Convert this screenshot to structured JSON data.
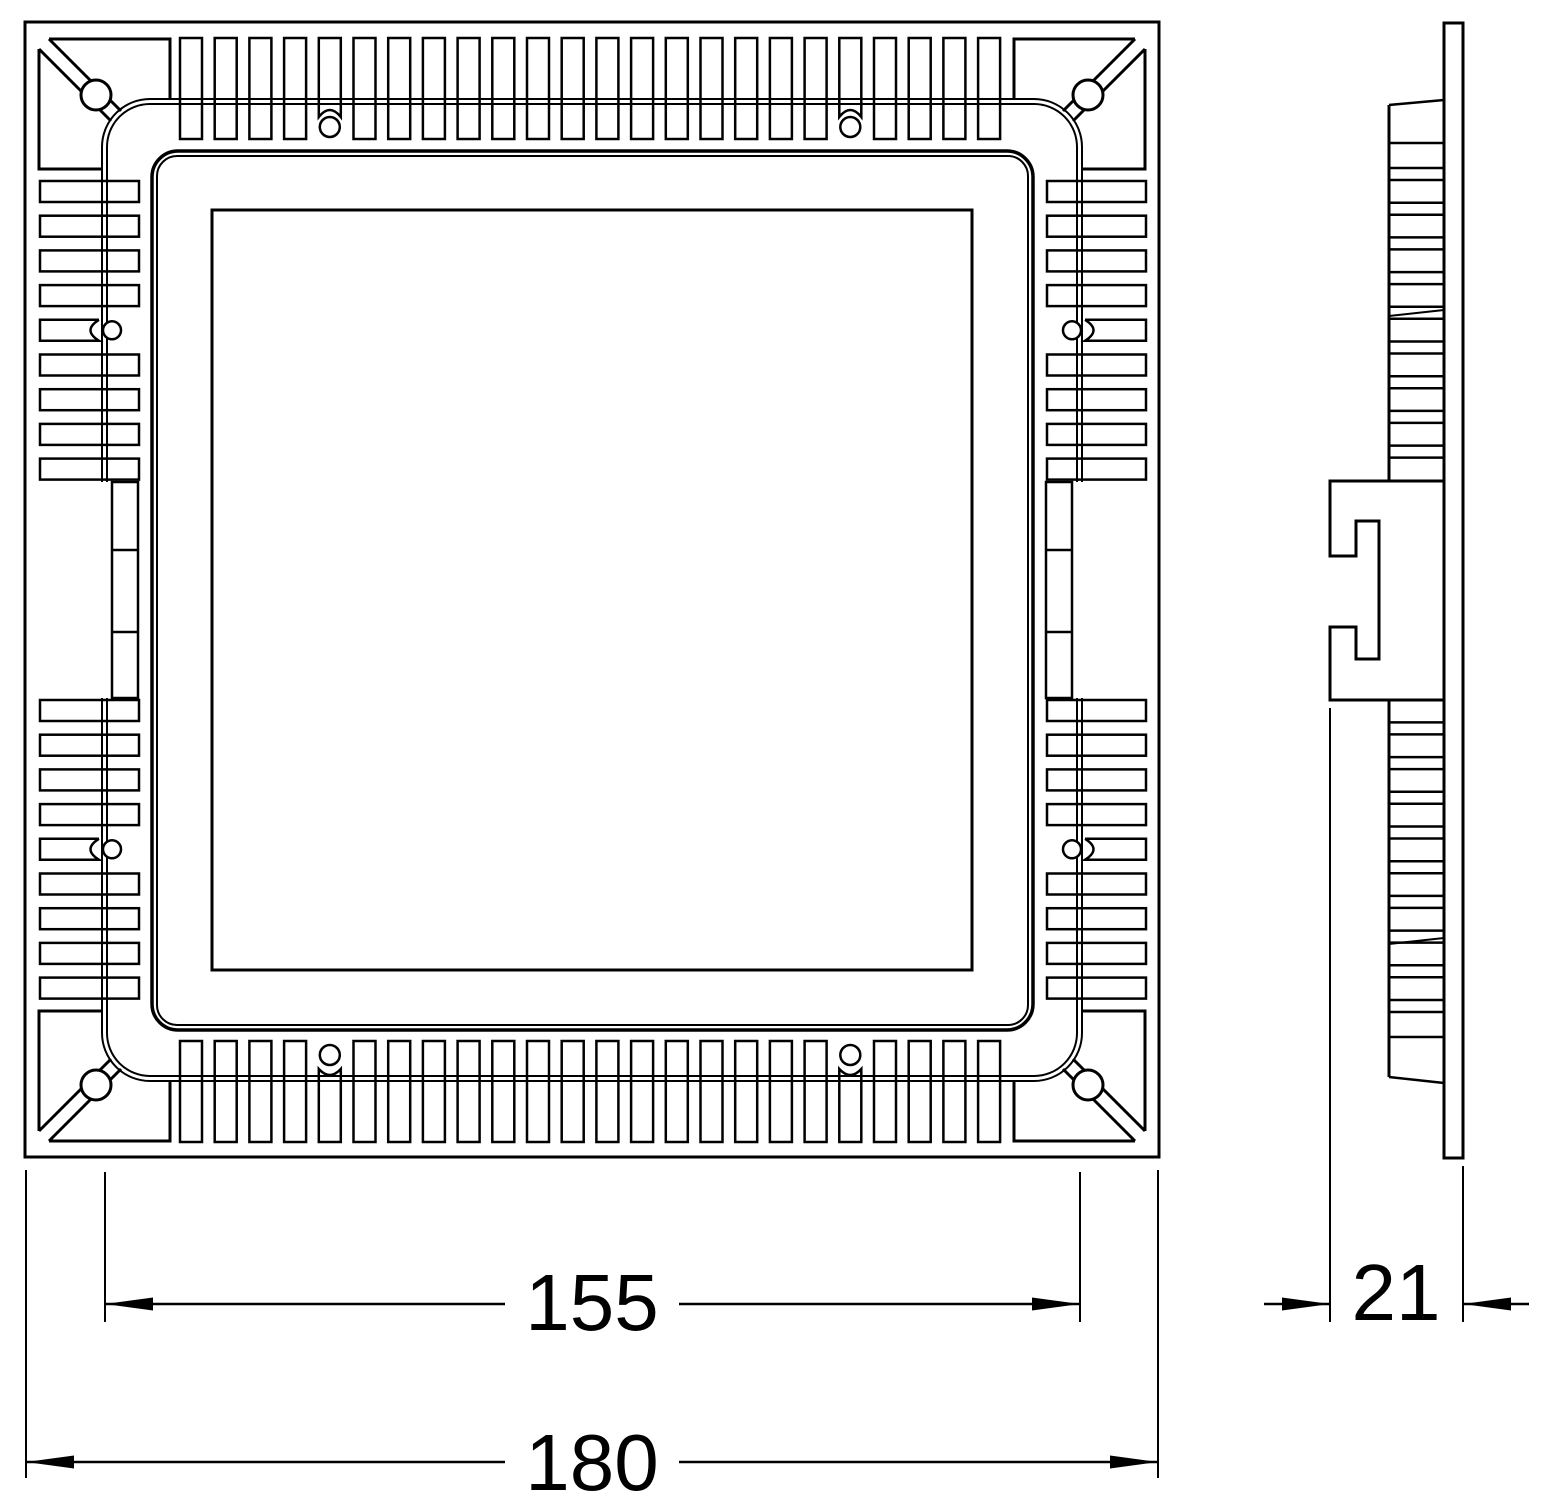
{
  "page": {
    "background": "#ffffff",
    "line_color": "#000000"
  },
  "dimensions": {
    "body_width": {
      "value": "155"
    },
    "overall_width": {
      "value": "180"
    },
    "depth": {
      "value": "21"
    }
  },
  "front_view": {
    "fin_count_top_edge": 24,
    "fin_count_bottom_edge": 24,
    "fin_group_count_left_edge": 9,
    "fin_group_count_right_edge": 9,
    "fin_groups_per_side_edge": 2,
    "notched_fin_indices_top_bottom": [
      4,
      19
    ],
    "notched_fin_index_side_groups": 4,
    "screw_hole_count": 8,
    "corner_clip_count": 4
  },
  "side_view": {
    "fin_slab_count_upper": 9,
    "fin_slab_count_lower": 9
  }
}
